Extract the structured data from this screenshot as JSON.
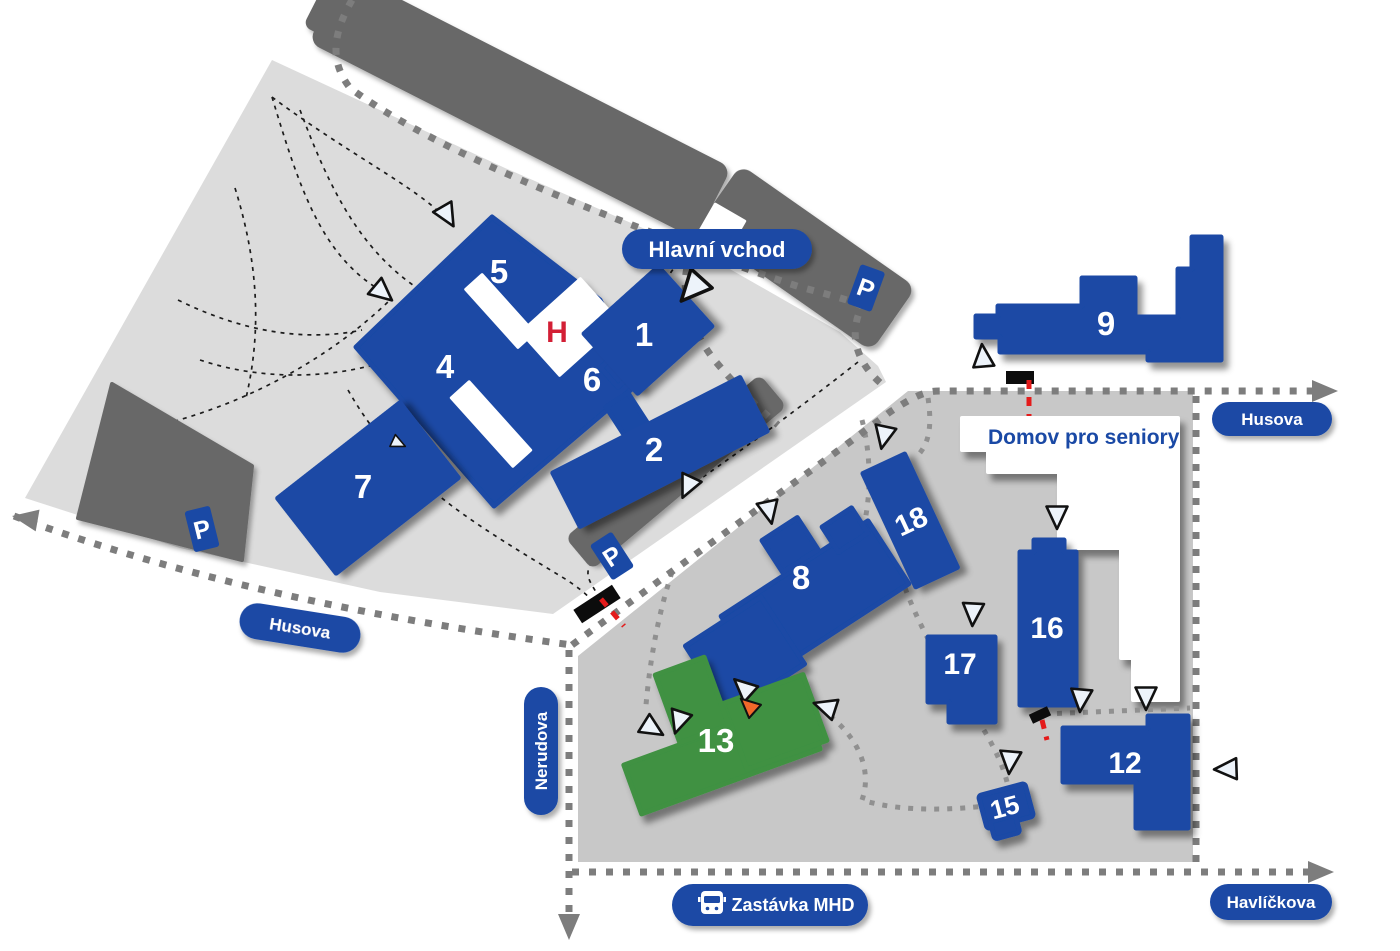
{
  "streets": {
    "husova_west": "Husova",
    "husova_north": "Husova",
    "nerudova": "Nerudova",
    "havlickova": "Havlíčkova"
  },
  "pois": {
    "main_entrance": "Hlavní vchod",
    "bus_stop": "Zastávka MHD",
    "seniors_home": "Domov pro seniory"
  },
  "glyphs": {
    "parking": "P",
    "helipad": "H"
  },
  "icons": {
    "bus": "bus-icon",
    "parking": "parking-sign-icon",
    "helipad": "helipad-icon",
    "entrance_marker": "entrance-triangle-icon",
    "gate": "gate-barrier-icon"
  },
  "buildings": [
    {
      "id": "1",
      "label": "1",
      "color": "blue"
    },
    {
      "id": "2",
      "label": "2",
      "color": "blue"
    },
    {
      "id": "3",
      "label": "3",
      "color": "blue"
    },
    {
      "id": "4",
      "label": "4",
      "color": "blue"
    },
    {
      "id": "5",
      "label": "5",
      "color": "blue"
    },
    {
      "id": "6",
      "label": "6",
      "color": "blue"
    },
    {
      "id": "7",
      "label": "7",
      "color": "blue"
    },
    {
      "id": "8",
      "label": "8",
      "color": "blue"
    },
    {
      "id": "9",
      "label": "9",
      "color": "blue"
    },
    {
      "id": "12",
      "label": "12",
      "color": "blue"
    },
    {
      "id": "13",
      "label": "13",
      "color": "green"
    },
    {
      "id": "15",
      "label": "15",
      "color": "blue"
    },
    {
      "id": "16",
      "label": "16",
      "color": "blue"
    },
    {
      "id": "17",
      "label": "17",
      "color": "blue"
    },
    {
      "id": "18",
      "label": "18",
      "color": "blue"
    }
  ],
  "colors": {
    "c-building": "#1a49a5",
    "c-building-green": "#3f9143",
    "c-campus-upper": "#dcdcdc",
    "c-campus-lower": "#c8c8c8",
    "c-strip": "#686868",
    "c-road-dot": "#7d7d7d",
    "c-walk": "#909090",
    "c-footpath": "#1c1c1c",
    "c-entrance": "#edf3fa",
    "c-entrance-orange": "#f2682a",
    "c-barrier": "#e41b1b",
    "c-helipad": "#d31f35",
    "c-label-bg": "#1a49a5",
    "c-label-text": "#ffffff"
  }
}
